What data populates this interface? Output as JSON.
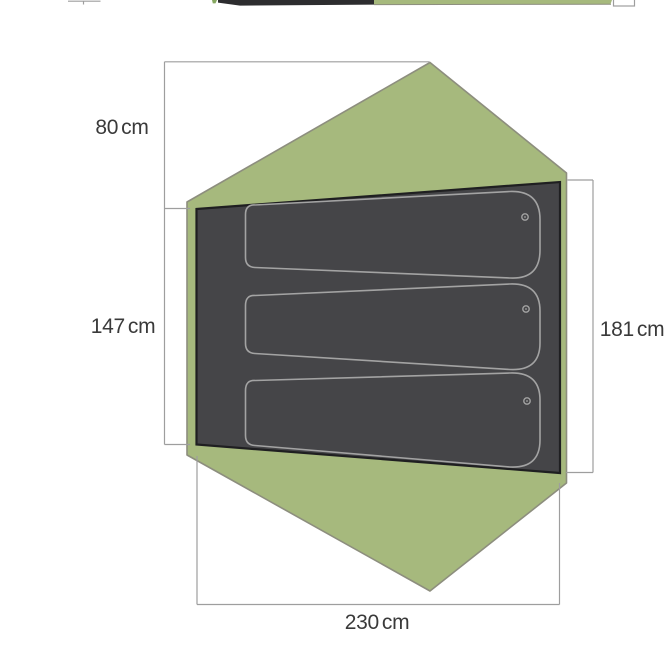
{
  "page": {
    "description": "Top-view floor plan diagram of a 3-person tent showing fly outline, interior floor with three sleeping pads, and dimension callouts"
  },
  "dimensions": {
    "left_top": {
      "value": "80",
      "unit": "cm"
    },
    "left_bottom": {
      "value": "147",
      "unit": "cm"
    },
    "right": {
      "value": "181",
      "unit": "cm"
    },
    "bottom": {
      "value": "230",
      "unit": "cm"
    }
  },
  "pads": {
    "count": 3
  },
  "icons": {
    "pad_valve_icon": "○"
  },
  "colors": {
    "tent_fly_green": "#a6b97d",
    "tent_outline_gray": "#8d8e7e",
    "floor_dark_gray": "#454548",
    "floor_outline_black": "#1f1f21",
    "pad_outline_gray": "#a3a3a3",
    "dimension_line_gray": "#9e9e9e",
    "label_text": "#3a3a3a",
    "background": "#ffffff"
  }
}
